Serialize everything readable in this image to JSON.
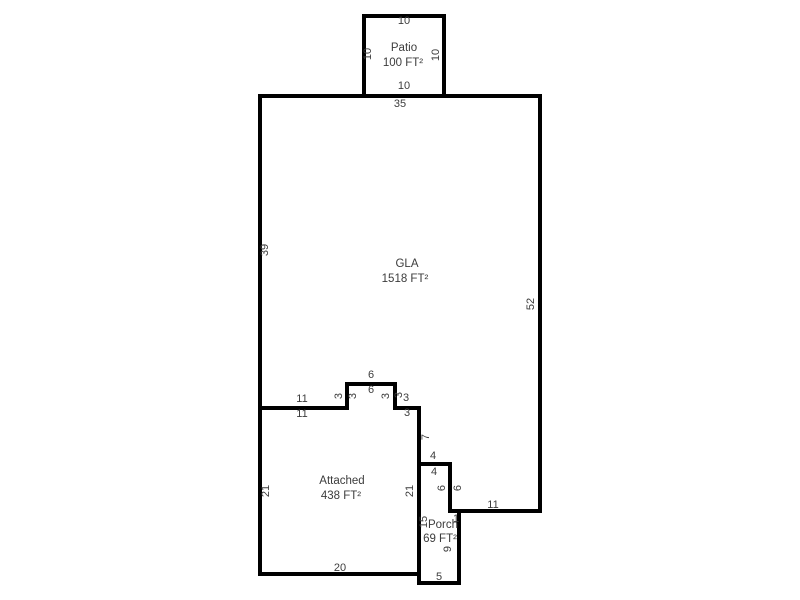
{
  "document": {
    "type": "floor-plan-sketch",
    "background": "#ffffff"
  },
  "style": {
    "wall_color": "#000000",
    "wall_width": 4,
    "label_color": "#3c3c3c",
    "dim_font_size": 11,
    "area_font_size": 11.5
  },
  "areas": [
    {
      "id": "patio",
      "name": "Patio",
      "size": "100 FT²",
      "name_x": 404,
      "name_y": 48,
      "size_x": 403,
      "size_y": 63
    },
    {
      "id": "gla",
      "name": "GLA",
      "size": "1518 FT²",
      "name_x": 407,
      "name_y": 264,
      "size_x": 405,
      "size_y": 279
    },
    {
      "id": "attached",
      "name": "Attached",
      "size": "438 FT²",
      "name_x": 342,
      "name_y": 481,
      "size_x": 341,
      "size_y": 496
    },
    {
      "id": "porch",
      "name": "Porch",
      "size": "69 FT²",
      "name_x": 443,
      "name_y": 525,
      "size_x": 440,
      "size_y": 539
    }
  ],
  "walls": [
    {
      "id": "outer-boundary",
      "closed": true,
      "points": "260,96 540,96 540,511 459,511 459,583 419,583 419,574 260,574"
    },
    {
      "id": "patio-outline",
      "closed": false,
      "points": "364,96 364,16 444,16 444,96"
    },
    {
      "id": "gla-attached-divider",
      "closed": false,
      "points": "260,408 347,408 347,384 395,384 395,408 419,408"
    },
    {
      "id": "attached-porch-divider",
      "closed": false,
      "points": "419,408 419,574"
    },
    {
      "id": "gla-porch-divider",
      "closed": false,
      "points": "419,464 450,464 450,511 459,511"
    }
  ],
  "dimensions": [
    {
      "text": "10",
      "x": 404,
      "y": 21,
      "rotate": 0
    },
    {
      "text": "10",
      "x": 368,
      "y": 54,
      "rotate": -90
    },
    {
      "text": "10",
      "x": 436,
      "y": 55,
      "rotate": -90
    },
    {
      "text": "10",
      "x": 404,
      "y": 86,
      "rotate": 0
    },
    {
      "text": "35",
      "x": 400,
      "y": 104,
      "rotate": 0
    },
    {
      "text": "39",
      "x": 265,
      "y": 250,
      "rotate": -90
    },
    {
      "text": "52",
      "x": 531,
      "y": 304,
      "rotate": -90
    },
    {
      "text": "11",
      "x": 302,
      "y": 399,
      "rotate": 0
    },
    {
      "text": "11",
      "x": 302,
      "y": 414,
      "rotate": 0
    },
    {
      "text": "3",
      "x": 339,
      "y": 396,
      "rotate": -90
    },
    {
      "text": "3",
      "x": 353,
      "y": 396,
      "rotate": -90
    },
    {
      "text": "6",
      "x": 371,
      "y": 375,
      "rotate": 0
    },
    {
      "text": "6",
      "x": 371,
      "y": 390,
      "rotate": 0
    },
    {
      "text": "3",
      "x": 386,
      "y": 396,
      "rotate": -90
    },
    {
      "text": "3",
      "x": 399,
      "y": 395,
      "rotate": -90
    },
    {
      "text": "3",
      "x": 406,
      "y": 398,
      "rotate": 0
    },
    {
      "text": "3",
      "x": 407,
      "y": 413,
      "rotate": 0
    },
    {
      "text": "7",
      "x": 426,
      "y": 437,
      "rotate": -90
    },
    {
      "text": "4",
      "x": 433,
      "y": 456,
      "rotate": 0
    },
    {
      "text": "4",
      "x": 434,
      "y": 472,
      "rotate": 0
    },
    {
      "text": "6",
      "x": 442,
      "y": 488,
      "rotate": -90
    },
    {
      "text": "6",
      "x": 458,
      "y": 488,
      "rotate": -90
    },
    {
      "text": "11",
      "x": 493,
      "y": 505,
      "rotate": 0
    },
    {
      "text": "1",
      "x": 456,
      "y": 519,
      "rotate": 0
    },
    {
      "text": "21",
      "x": 266,
      "y": 491,
      "rotate": -90
    },
    {
      "text": "21",
      "x": 410,
      "y": 491,
      "rotate": -90
    },
    {
      "text": "15",
      "x": 424,
      "y": 522,
      "rotate": -90
    },
    {
      "text": "9",
      "x": 448,
      "y": 549,
      "rotate": -90
    },
    {
      "text": "20",
      "x": 340,
      "y": 568,
      "rotate": 0
    },
    {
      "text": "5",
      "x": 439,
      "y": 577,
      "rotate": 0
    }
  ]
}
